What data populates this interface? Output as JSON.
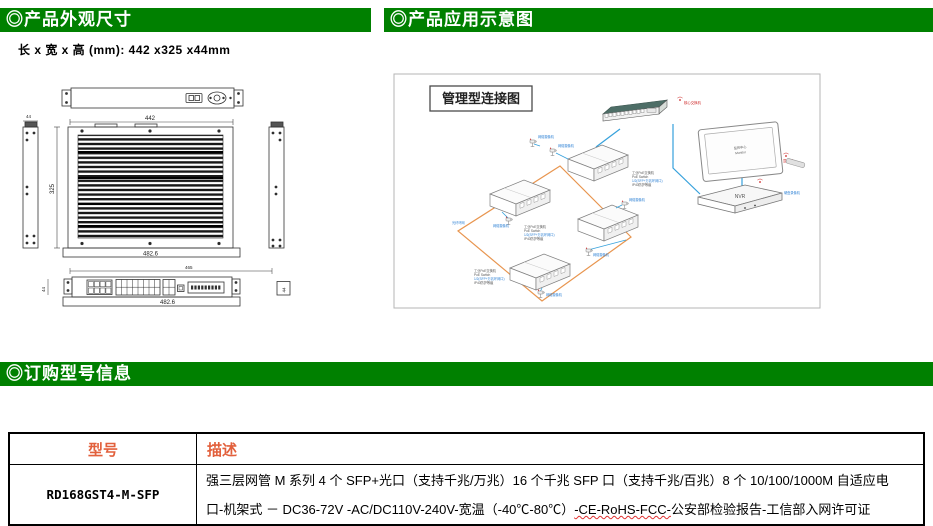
{
  "sections": {
    "appearance": {
      "title": "◎产品外观尺寸"
    },
    "application": {
      "title": "◎产品应用示意图"
    },
    "ordering": {
      "title": "◎订购型号信息"
    }
  },
  "dimensions_line": "长 x 宽 x 高 (mm): 442 x325 x44mm",
  "drawing": {
    "top_width_mm": "442",
    "depth_mm": "325",
    "height_mm": "44",
    "overall_width_mm": "482.6",
    "front_width_mm": "465",
    "front_overall_mm": "482.6",
    "front_height_mm": "44",
    "front_depth_mm": "44"
  },
  "diagram": {
    "title": "管理型连接图",
    "core_switch_label": "核心交换机",
    "monitor_label": "监控中心",
    "monitor_sub_label": "Monitor",
    "monitor_side_label": "显示器",
    "nvr_label": "NVR",
    "nvr_side_label": "硬盘录像机",
    "camera_label": "网络摄像机",
    "ring_label": "光纤环网",
    "device_label_line1": "工业PoE交换机",
    "device_label_line2": "PoE Switch",
    "device_label_line3": "1/2(SFP+万兆环网口)",
    "device_label_line4": "IP40防护等级"
  },
  "table": {
    "headers": [
      "型号",
      "描述"
    ],
    "rows": [
      {
        "model": "RD168GST4-M-SFP",
        "description_line1": "强三层网管 M 系列 4 个 SFP+光口（支持千兆/万兆）16 个千兆 SFP 口（支持千兆/百兆）8 个 10/100/1000M 自适应电",
        "description_line2_pre": "口-机架式 － DC36-72V -AC/DC110V-240V-宽温（-40℃-80℃）",
        "description_line2_wavy": "-CE-RoHS-FCC-",
        "description_line2_post": "公安部检验报告-工信部入网许可证"
      }
    ]
  },
  "colors": {
    "green": "#008000",
    "orange": "#e2603c",
    "ring": "#e8954f",
    "blue": "#36a1dc",
    "labelblue": "#2a7fd4",
    "red": "#cc2222"
  }
}
